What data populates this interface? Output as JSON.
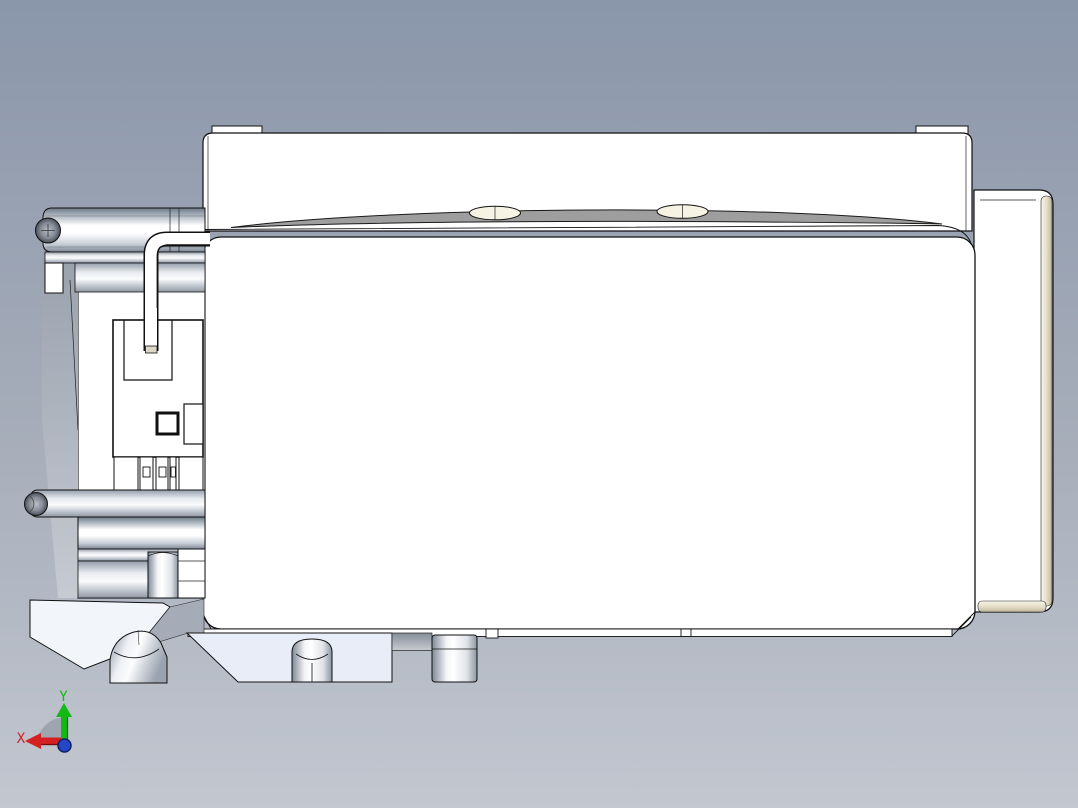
{
  "viewport": {
    "background": {
      "top": "#8a96aa",
      "bottom": "#c2c7d0"
    },
    "axis_triad": {
      "x_label": "X",
      "y_label": "Y",
      "x_color": "#d42020",
      "y_color": "#14b814",
      "origin_color": "#2646c8"
    },
    "model": {
      "body_fill": "#ffffff",
      "outline_color": "#111111",
      "top_surface_fill": "#9e9e9e",
      "hole_fill": "#f6f2e4",
      "base_plate_fill": "#e9edf8",
      "edge_highlight_fill": "#e3ddc6"
    }
  }
}
